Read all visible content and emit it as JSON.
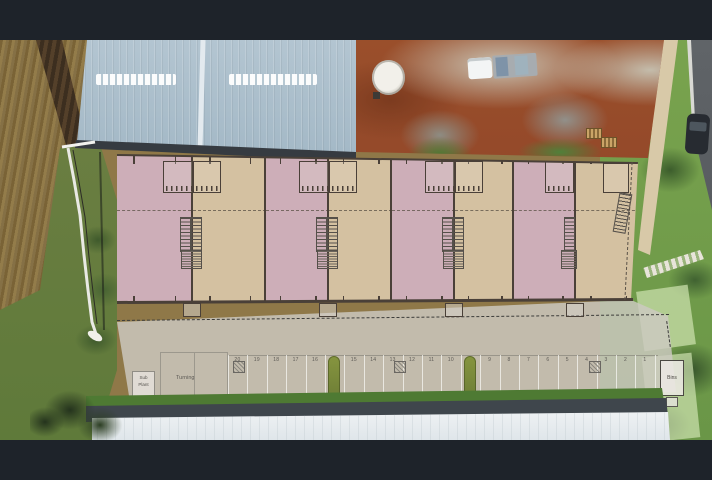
{
  "window": {
    "letterbox_color": "#1e232a",
    "description": "Aerial drone photograph of an industrial unit development with a coloured site-plan overlay, letterboxed top and bottom"
  },
  "photo": {
    "existing_building_roof_color": "#a9bdc8",
    "dirt_color": "#9a4f2b",
    "grass_color": "#75a14c",
    "road_color": "#606468"
  },
  "plan_overlay": {
    "unit_fill_pink": "#cdaeb8",
    "unit_fill_tan": "#d4c1a1",
    "line_color": "#4a4038",
    "apron_color": "#cdc9c2",
    "units": [
      {
        "name": "unit-1",
        "fill": "pink"
      },
      {
        "name": "unit-2",
        "fill": "tan"
      },
      {
        "name": "unit-3",
        "fill": "pink"
      },
      {
        "name": "unit-4",
        "fill": "tan"
      },
      {
        "name": "unit-5",
        "fill": "pink"
      },
      {
        "name": "unit-6",
        "fill": "tan"
      },
      {
        "name": "unit-7",
        "fill": "pink"
      },
      {
        "name": "unit-8",
        "fill": "tan"
      }
    ],
    "labels": {
      "turning": "Turning",
      "plant_line1": "Sub",
      "plant_line2": "Plant",
      "bins": "Bins"
    },
    "parking": {
      "stalls": [
        {
          "label": "20"
        },
        {
          "label": "19"
        },
        {
          "label": "18"
        },
        {
          "label": "17"
        },
        {
          "label": "16"
        },
        {
          "island": true
        },
        {
          "label": "15"
        },
        {
          "label": "14"
        },
        {
          "label": "13"
        },
        {
          "label": "12"
        },
        {
          "label": "11"
        },
        {
          "label": "10"
        },
        {
          "island": true
        },
        {
          "label": "9"
        },
        {
          "label": "8"
        },
        {
          "label": "7"
        },
        {
          "label": "6"
        },
        {
          "label": "5"
        },
        {
          "label": "4"
        },
        {
          "label": "3"
        },
        {
          "label": "2"
        },
        {
          "label": "1"
        }
      ]
    }
  }
}
